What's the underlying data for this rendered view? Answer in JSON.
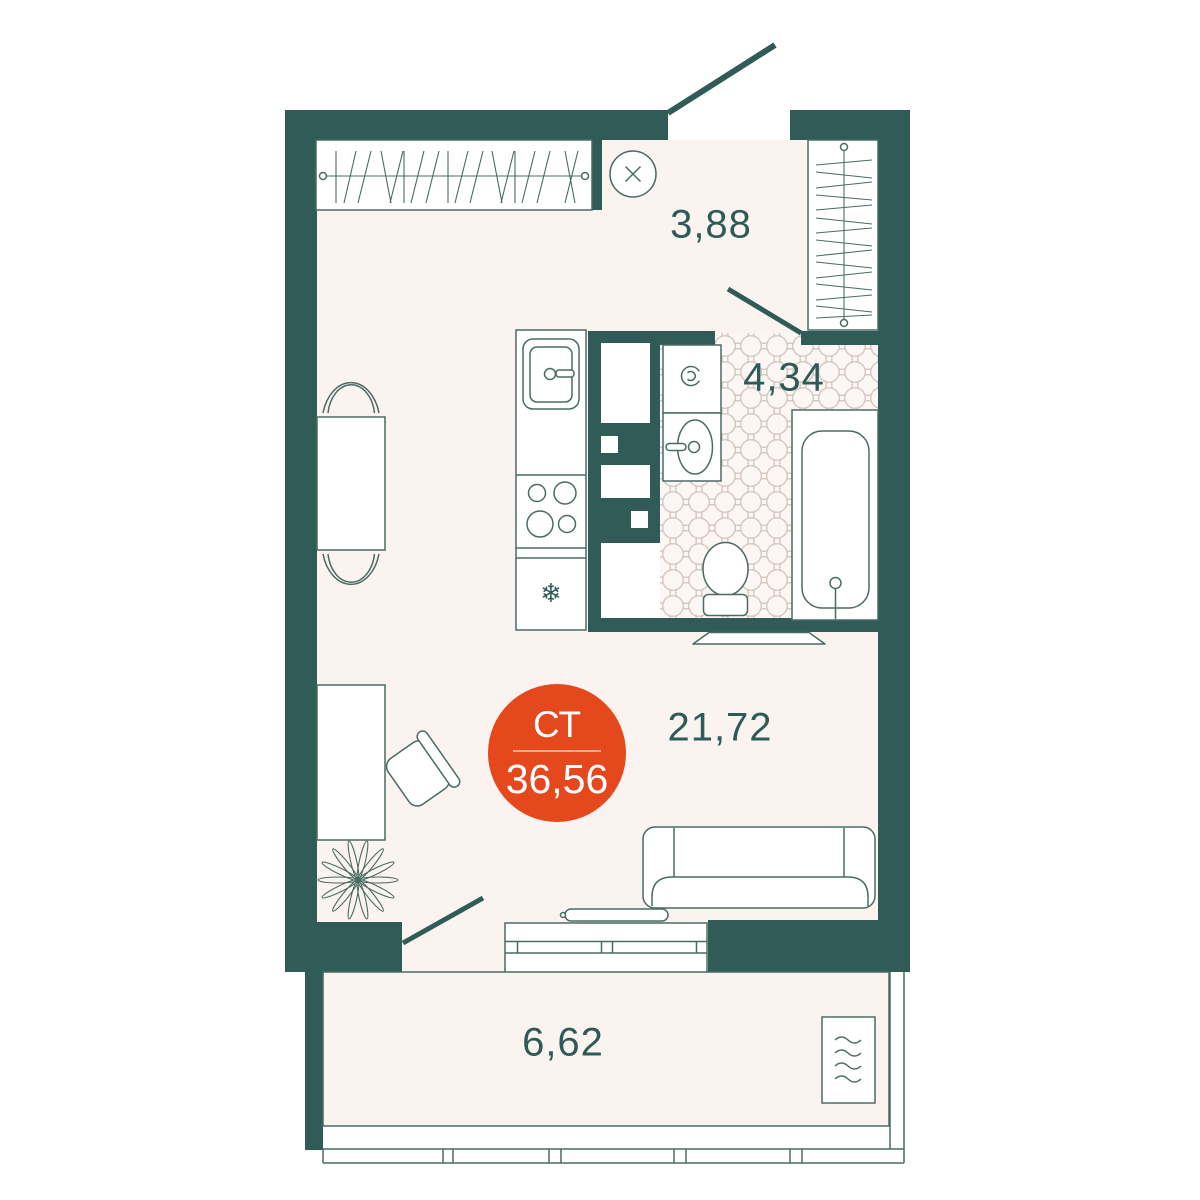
{
  "plan": {
    "badge": {
      "type": "СТ",
      "area": "36,56"
    },
    "rooms": [
      {
        "name": "hallway",
        "area": "3,88"
      },
      {
        "name": "bathroom",
        "area": "4,34"
      },
      {
        "name": "living-room",
        "area": "21,72"
      },
      {
        "name": "balcony",
        "area": "6,62"
      }
    ],
    "icons": {
      "snowflake": "❄"
    }
  },
  "colors": {
    "wall": "#305B56",
    "line": "#4A6B64",
    "floor": "#FBF3F0",
    "accent": "#E5481C",
    "label": "#2E5B57",
    "tile": "#D9CCC6",
    "white": "#FFFFFF"
  }
}
